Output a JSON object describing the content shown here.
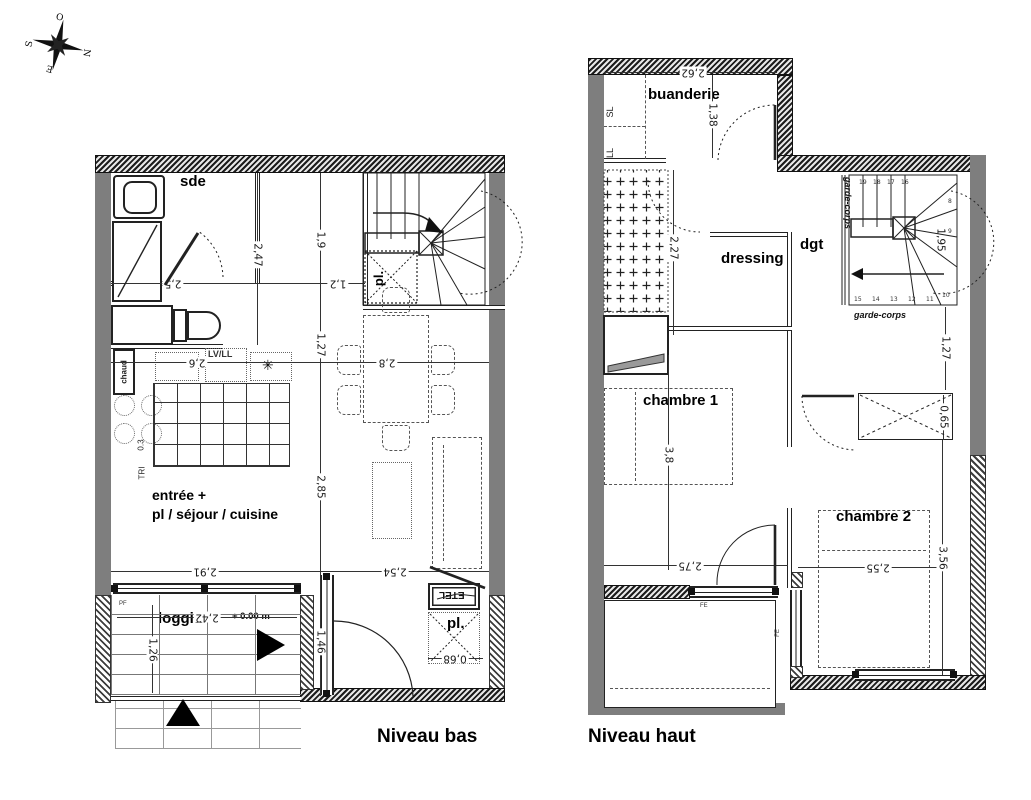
{
  "compass": {
    "o": "O",
    "n": "N",
    "e": "E",
    "s": "S"
  },
  "captions": {
    "bas": "Niveau bas",
    "haut": "Niveau haut"
  },
  "colors": {
    "wall": "#7e7e7e",
    "hatch": "#1c1c1c",
    "text": "#000000"
  },
  "niveau_bas": {
    "labels": {
      "sde": "sde",
      "entree_line1": "entrée +",
      "entree_line2": "pl / séjour / cuisine",
      "loggia": "loggia",
      "level": "+ 0.00 m",
      "pl_stair": "pl.",
      "pl_entry": "pl.",
      "chaud": "chaud",
      "tri": "TRI",
      "zero3": "0.3",
      "lvll": "LV/LL",
      "etel": "ETEL",
      "pf": "PF",
      "star": "✳"
    },
    "dims": {
      "d25": "2,5",
      "d247": "2,47",
      "d19": "1,9",
      "d12": "1,2",
      "d127": "1,27",
      "d26": "2,6",
      "d28": "2,8",
      "d285": "2,85",
      "d291": "2,91",
      "d254": "2,54",
      "d242": "2,42",
      "d126": "1,26",
      "d146": "1,46",
      "d068": "0,68"
    }
  },
  "niveau_haut": {
    "labels": {
      "buanderie": "buanderie",
      "sl": "SL",
      "ll": "LL",
      "dressing": "dressing",
      "dgt": "dgt",
      "chambre1": "chambre 1",
      "chambre2": "chambre 2",
      "pl": "pl.",
      "garde_corps_left": "garde-corps",
      "garde_corps_bottom": "garde-corps",
      "fe1": "FE",
      "fe2": "FE"
    },
    "dims": {
      "d262": "2,62",
      "d138": "1,38",
      "d227": "2,27",
      "d195": "1,95",
      "d127": "1,27",
      "d065": "0,65",
      "d38": "3,8",
      "d275": "2,75",
      "d255": "2,55",
      "d356": "3,56"
    },
    "stair_numbers": {
      "top": [
        "19",
        "18",
        "17",
        "16"
      ],
      "right": [
        "8",
        "9"
      ],
      "bottom": [
        "15",
        "14",
        "13",
        "12",
        "11",
        "10"
      ]
    }
  }
}
